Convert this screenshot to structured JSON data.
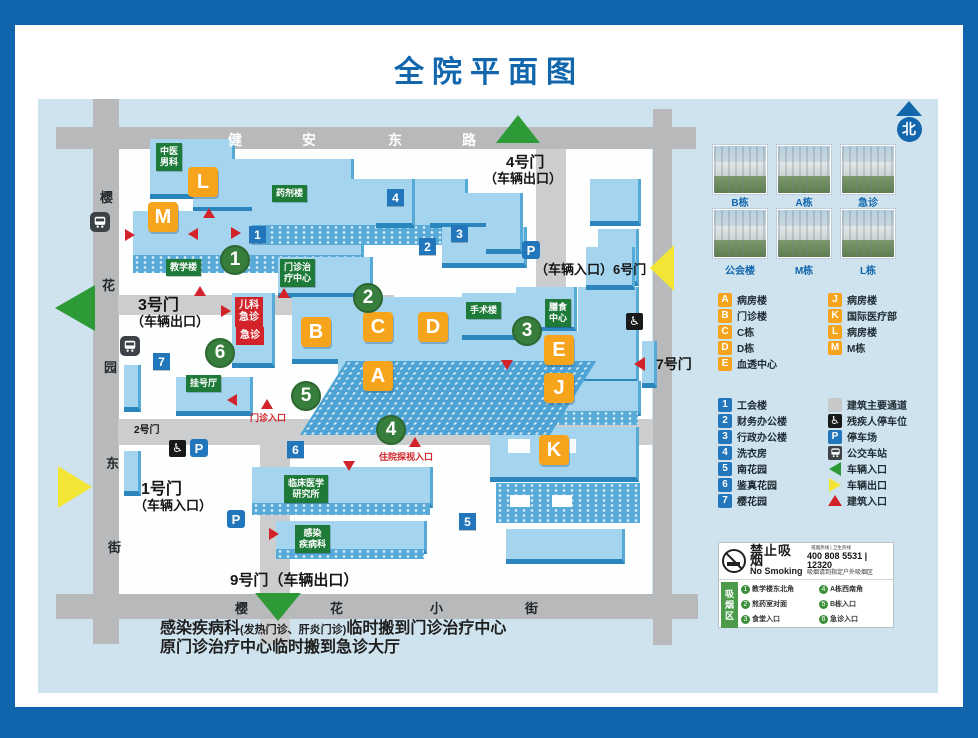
{
  "title": "全院平面图",
  "colors": {
    "frame_blue": "#1065ad",
    "title_blue": "#1266ac",
    "board_bg": "#cfe3ee",
    "road_gray": "#b7b9bb",
    "building_blue": "#a5d5ee",
    "building_orange": "#f7a41d",
    "site_green": "#377d3b",
    "label_green": "#1d7a38",
    "alert_red": "#d2232a",
    "info_blue": "#2276bc",
    "vehicle_green": "#2e9a37",
    "vehicle_yellow": "#f2e535"
  },
  "map": {
    "markers": [
      {
        "t": "stw",
        "x": 190,
        "y": 31,
        "tx": "健",
        "name": "street-jianan-1"
      },
      {
        "t": "stw",
        "x": 264,
        "y": 31,
        "tx": "安",
        "name": "street-jianan-2"
      },
      {
        "t": "stw",
        "x": 350,
        "y": 31,
        "tx": "东",
        "name": "street-jianan-3"
      },
      {
        "t": "stw",
        "x": 424,
        "y": 31,
        "tx": "路",
        "name": "street-jianan-4"
      },
      {
        "t": "std",
        "x": 62,
        "y": 88,
        "tx": "樱",
        "name": "street-west-1"
      },
      {
        "t": "std",
        "x": 64,
        "y": 176,
        "tx": "花",
        "name": "street-west-2"
      },
      {
        "t": "std",
        "x": 66,
        "y": 258,
        "tx": "园",
        "name": "street-west-3"
      },
      {
        "t": "std",
        "x": 68,
        "y": 354,
        "tx": "东",
        "name": "street-west-4"
      },
      {
        "t": "std",
        "x": 70,
        "y": 438,
        "tx": "街",
        "name": "street-west-5"
      },
      {
        "t": "std",
        "x": 197,
        "y": 499,
        "tx": "樱",
        "name": "street-south-1"
      },
      {
        "t": "std",
        "x": 292,
        "y": 499,
        "tx": "花",
        "name": "street-south-2"
      },
      {
        "t": "std",
        "x": 392,
        "y": 499,
        "tx": "小",
        "name": "street-south-3"
      },
      {
        "t": "std",
        "x": 487,
        "y": 499,
        "tx": "街",
        "name": "street-south-4"
      },
      {
        "t": "gate",
        "x": 468,
        "y": 52,
        "fs": 15,
        "tx": "4号门",
        "name": "gate-4-label"
      },
      {
        "t": "gate",
        "x": 446,
        "y": 69,
        "fs": 13,
        "tx": "（车辆出口）",
        "name": "gate-4-sub"
      },
      {
        "t": "gate",
        "x": 497,
        "y": 160,
        "fs": 13,
        "tx": "（车辆入口）6号门",
        "name": "gate-6-label"
      },
      {
        "t": "gate",
        "x": 618,
        "y": 255,
        "fs": 14,
        "tx": "7号门",
        "name": "gate-7-label"
      },
      {
        "t": "gate",
        "x": 100,
        "y": 192,
        "fs": 16,
        "tx": "3号门",
        "name": "gate-3-label"
      },
      {
        "t": "gate",
        "x": 93,
        "y": 212,
        "fs": 13,
        "tx": "（车辆出口）",
        "name": "gate-3-sub"
      },
      {
        "t": "gate",
        "x": 96,
        "y": 322,
        "fs": 10,
        "tx": "2号门",
        "name": "gate-2-label"
      },
      {
        "t": "gate",
        "x": 103,
        "y": 376,
        "fs": 16,
        "tx": "1号门",
        "name": "gate-1-label"
      },
      {
        "t": "gate",
        "x": 96,
        "y": 396,
        "fs": 13,
        "tx": "（车辆入口）",
        "name": "gate-1-sub"
      },
      {
        "t": "gate",
        "x": 192,
        "y": 470,
        "fs": 15,
        "tx": "9号门（车辆出口）",
        "name": "gate-9-label"
      },
      {
        "t": "tri",
        "x": 458,
        "y": 16,
        "dir": "up",
        "c": "#2e9a37",
        "w": 44,
        "h": 28,
        "name": "gate4-arrow-icon"
      },
      {
        "t": "tri",
        "x": 612,
        "y": 146,
        "dir": "left",
        "c": "#f2e535",
        "w": 24,
        "h": 46,
        "name": "gate6-arrow-icon"
      },
      {
        "t": "tri",
        "x": 596,
        "y": 258,
        "dir": "left",
        "c": "#d2232a",
        "w": 11,
        "h": 14,
        "name": "gate7-arrow-icon"
      },
      {
        "t": "tri",
        "x": 17,
        "y": 186,
        "dir": "left",
        "c": "#2e9a37",
        "w": 40,
        "h": 46,
        "name": "gate3-arrow-icon"
      },
      {
        "t": "tri",
        "x": 20,
        "y": 367,
        "dir": "right",
        "c": "#f2e535",
        "w": 34,
        "h": 42,
        "name": "gate1-arrow-icon"
      },
      {
        "t": "tri",
        "x": 217,
        "y": 494,
        "dir": "down",
        "c": "#2e9a37",
        "w": 46,
        "h": 28,
        "name": "gate9-arrow-icon"
      },
      {
        "t": "letter",
        "x": 150,
        "y": 68,
        "tx": "L"
      },
      {
        "t": "letter",
        "x": 110,
        "y": 103,
        "tx": "M"
      },
      {
        "t": "letter",
        "x": 263,
        "y": 218,
        "tx": "B"
      },
      {
        "t": "letter",
        "x": 325,
        "y": 213,
        "tx": "C"
      },
      {
        "t": "letter",
        "x": 380,
        "y": 213,
        "tx": "D"
      },
      {
        "t": "letter",
        "x": 325,
        "y": 262,
        "tx": "A"
      },
      {
        "t": "letter",
        "x": 506,
        "y": 236,
        "tx": "E"
      },
      {
        "t": "letter",
        "x": 506,
        "y": 274,
        "tx": "J"
      },
      {
        "t": "letter",
        "x": 501,
        "y": 336,
        "tx": "K"
      },
      {
        "t": "circle",
        "x": 182,
        "y": 146,
        "tx": "1"
      },
      {
        "t": "circle",
        "x": 315,
        "y": 184,
        "tx": "2"
      },
      {
        "t": "circle",
        "x": 474,
        "y": 217,
        "tx": "3"
      },
      {
        "t": "circle",
        "x": 338,
        "y": 316,
        "tx": "4"
      },
      {
        "t": "circle",
        "x": 253,
        "y": 282,
        "tx": "5"
      },
      {
        "t": "circle",
        "x": 167,
        "y": 239,
        "tx": "6"
      },
      {
        "t": "bluenum",
        "x": 349,
        "y": 90,
        "tx": "4"
      },
      {
        "t": "bluenum",
        "x": 211,
        "y": 127,
        "tx": "1"
      },
      {
        "t": "bluenum",
        "x": 413,
        "y": 126,
        "tx": "3"
      },
      {
        "t": "bluenum",
        "x": 381,
        "y": 139,
        "tx": "2"
      },
      {
        "t": "bluenum",
        "x": 115,
        "y": 254,
        "tx": "7"
      },
      {
        "t": "bluenum",
        "x": 249,
        "y": 342,
        "tx": "6"
      },
      {
        "t": "bluenum",
        "x": 421,
        "y": 414,
        "tx": "5"
      },
      {
        "t": "glabel",
        "x": 118,
        "y": 44,
        "tx": "中医\n男科",
        "name": "label-tcm-male-dept"
      },
      {
        "t": "glabel",
        "x": 234,
        "y": 86,
        "tx": "药剂楼",
        "name": "label-pharmacy-building"
      },
      {
        "t": "glabel",
        "x": 128,
        "y": 160,
        "tx": "教学楼",
        "name": "label-teaching-building"
      },
      {
        "t": "glabel",
        "x": 242,
        "y": 160,
        "tx": "门诊治\n疗中心",
        "name": "label-outpatient-treatment-center"
      },
      {
        "t": "glabel",
        "x": 148,
        "y": 276,
        "tx": "挂号厅",
        "name": "label-registration-hall"
      },
      {
        "t": "glabel",
        "x": 428,
        "y": 203,
        "tx": "手术楼",
        "name": "label-surgery-building"
      },
      {
        "t": "glabel",
        "x": 507,
        "y": 200,
        "tx": "膳食\n中心",
        "name": "label-dietary-center"
      },
      {
        "t": "glabel",
        "x": 246,
        "y": 376,
        "tx": "临床医学\n研究所",
        "name": "label-clinical-research-institute"
      },
      {
        "t": "glabel",
        "x": 257,
        "y": 426,
        "tx": "感染\n疾病科",
        "name": "label-infectious-disease-dept"
      },
      {
        "t": "rbox",
        "x": 197,
        "y": 198,
        "tx": "儿科\n急诊",
        "name": "label-pediatric-emergency"
      },
      {
        "t": "rbox",
        "x": 198,
        "y": 228,
        "tx": "急诊",
        "name": "label-emergency"
      },
      {
        "t": "rtext",
        "x": 212,
        "y": 312,
        "tx": "门诊入口",
        "name": "label-outpatient-entrance"
      },
      {
        "t": "rtext",
        "x": 341,
        "y": 351,
        "tx": "住院探视入口",
        "name": "label-inpatient-visit-entrance"
      },
      {
        "t": "tri",
        "x": 165,
        "y": 109,
        "dir": "up",
        "c": "#d2232a",
        "w": 13,
        "h": 10,
        "name": "building-entrance-arrow"
      },
      {
        "t": "tri",
        "x": 156,
        "y": 187,
        "dir": "up",
        "c": "#d2232a",
        "w": 13,
        "h": 10,
        "name": "building-entrance-arrow"
      },
      {
        "t": "tri",
        "x": 240,
        "y": 189,
        "dir": "up",
        "c": "#d2232a",
        "w": 13,
        "h": 10,
        "name": "building-entrance-arrow"
      },
      {
        "t": "tri",
        "x": 223,
        "y": 300,
        "dir": "up",
        "c": "#d2232a",
        "w": 13,
        "h": 10,
        "name": "building-entrance-arrow"
      },
      {
        "t": "tri",
        "x": 371,
        "y": 338,
        "dir": "up",
        "c": "#d2232a",
        "w": 13,
        "h": 10,
        "name": "building-entrance-arrow"
      },
      {
        "t": "tri",
        "x": 87,
        "y": 130,
        "dir": "right",
        "c": "#d2232a",
        "w": 10,
        "h": 13,
        "name": "building-entrance-arrow"
      },
      {
        "t": "tri",
        "x": 193,
        "y": 128,
        "dir": "right",
        "c": "#d2232a",
        "w": 10,
        "h": 13,
        "name": "building-entrance-arrow"
      },
      {
        "t": "tri",
        "x": 183,
        "y": 206,
        "dir": "right",
        "c": "#d2232a",
        "w": 10,
        "h": 13,
        "name": "building-entrance-arrow"
      },
      {
        "t": "tri",
        "x": 231,
        "y": 429,
        "dir": "right",
        "c": "#d2232a",
        "w": 10,
        "h": 13,
        "name": "building-entrance-arrow"
      },
      {
        "t": "tri",
        "x": 150,
        "y": 129,
        "dir": "left",
        "c": "#d2232a",
        "w": 10,
        "h": 13,
        "name": "building-entrance-arrow"
      },
      {
        "t": "tri",
        "x": 189,
        "y": 295,
        "dir": "left",
        "c": "#d2232a",
        "w": 10,
        "h": 13,
        "name": "building-entrance-arrow"
      },
      {
        "t": "tri",
        "x": 305,
        "y": 362,
        "dir": "down",
        "c": "#d2232a",
        "w": 13,
        "h": 10,
        "name": "building-entrance-arrow"
      },
      {
        "t": "tri",
        "x": 463,
        "y": 261,
        "dir": "down",
        "c": "#d2232a",
        "w": 13,
        "h": 10,
        "name": "building-entrance-arrow"
      },
      {
        "t": "p",
        "x": 484,
        "y": 142,
        "tx": "P",
        "name": "parking-icon"
      },
      {
        "t": "p",
        "x": 152,
        "y": 340,
        "tx": "P",
        "name": "parking-icon"
      },
      {
        "t": "p",
        "x": 189,
        "y": 411,
        "tx": "P",
        "name": "parking-icon"
      },
      {
        "t": "wc",
        "x": 131,
        "y": 341,
        "tx": "♿",
        "name": "disabled-parking-icon"
      },
      {
        "t": "wc",
        "x": 588,
        "y": 214,
        "tx": "♿",
        "name": "disabled-parking-icon"
      },
      {
        "t": "bus",
        "x": 52,
        "y": 113,
        "name": "bus-stop-icon"
      },
      {
        "t": "bus",
        "x": 82,
        "y": 237,
        "name": "bus-stop-icon"
      }
    ]
  },
  "legend": {
    "north_label": "北",
    "photos": [
      {
        "label": "B栋"
      },
      {
        "label": "A栋"
      },
      {
        "label": "急诊"
      },
      {
        "label": "公会楼"
      },
      {
        "label": "M栋"
      },
      {
        "label": "L栋"
      }
    ],
    "letters_col1": [
      {
        "key": "A",
        "label": "病房楼"
      },
      {
        "key": "B",
        "label": "门诊楼"
      },
      {
        "key": "C",
        "label": "C栋"
      },
      {
        "key": "D",
        "label": "D栋"
      },
      {
        "key": "E",
        "label": "血透中心"
      }
    ],
    "letters_col2": [
      {
        "key": "J",
        "label": "病房楼"
      },
      {
        "key": "K",
        "label": "国际医疗部"
      },
      {
        "key": "L",
        "label": "病房楼"
      },
      {
        "key": "M",
        "label": "M栋"
      }
    ],
    "numbers": [
      {
        "key": "1",
        "label": "工会楼"
      },
      {
        "key": "2",
        "label": "财务办公楼"
      },
      {
        "key": "3",
        "label": "行政办公楼"
      },
      {
        "key": "4",
        "label": "洗衣房"
      },
      {
        "key": "5",
        "label": "南花园"
      },
      {
        "key": "6",
        "label": "鉴真花园"
      },
      {
        "key": "7",
        "label": "樱花园"
      }
    ],
    "symbols": [
      {
        "icon": "path-square",
        "label": "建筑主要通道"
      },
      {
        "icon": "wheelchair",
        "label": "残疾人停车位"
      },
      {
        "icon": "parking",
        "label": "停车场"
      },
      {
        "icon": "bus",
        "label": "公交车站"
      },
      {
        "icon": "tri-left-green",
        "label": "车辆入口"
      },
      {
        "icon": "tri-right-yellow",
        "label": "车辆出口"
      },
      {
        "icon": "tri-up-red",
        "label": "建筑入口"
      }
    ]
  },
  "no_smoking": {
    "title_cn": "禁止吸烟",
    "title_en": "No Smoking",
    "hotline1": "戒烟热线",
    "hotline2": "卫生热线",
    "phone1": "400 808 5531",
    "phone2": "12320",
    "note": "吸烟请到指定户外吸烟区",
    "zone_label": "吸烟区",
    "spots": [
      "教学楼东北角",
      "煎药室对面",
      "食堂入口",
      "A栋西南角",
      "B栋入口",
      "急诊入口"
    ]
  },
  "footnote": {
    "line1_main": "感染疾病科",
    "line1_small": "(发热门诊、肝炎门诊)",
    "line1_rest": "临时搬到门诊治疗中心",
    "line2": "原门诊治疗中心临时搬到急诊大厅"
  }
}
